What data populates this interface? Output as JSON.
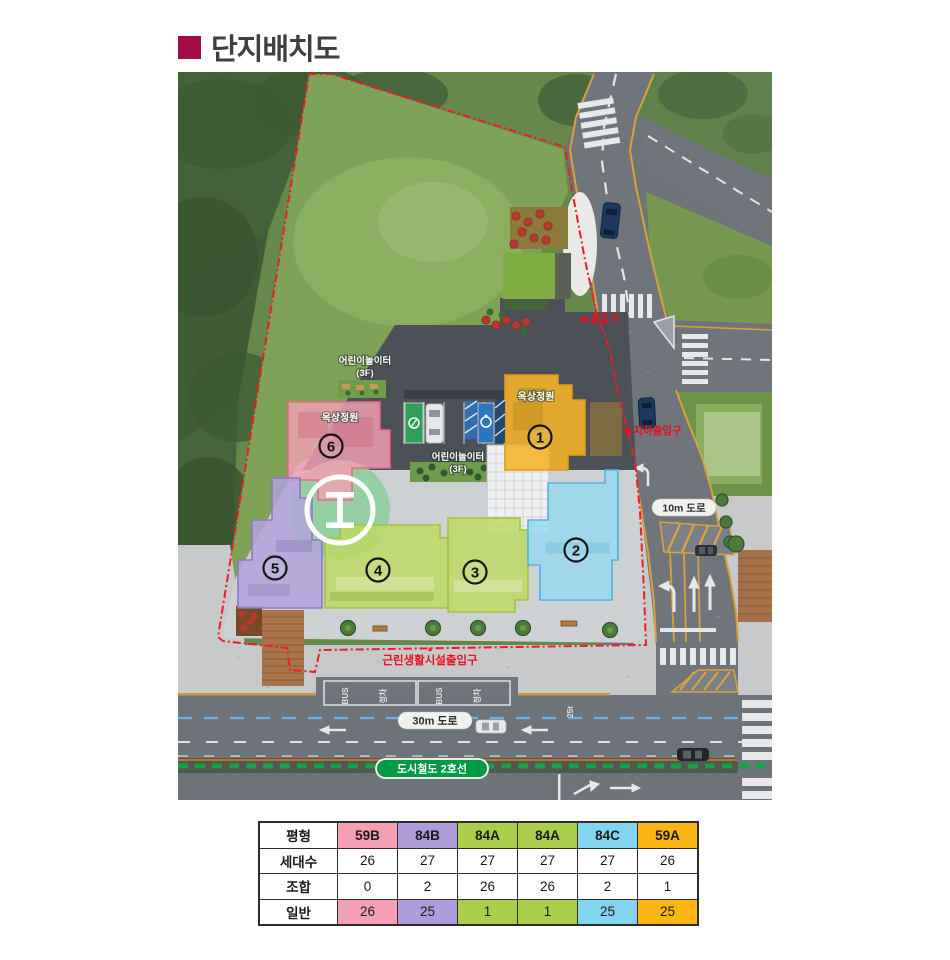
{
  "title": "단지배치도",
  "map": {
    "labels": {
      "playground_top_1": "어린이놀이터",
      "playground_top_2": "(3F)",
      "playground_mid_1": "어린이놀이터",
      "playground_mid_2": "(3F)",
      "roof_garden_b6": "옥상정원",
      "roof_garden_b1": "옥상정원",
      "entrance": "◀ 출입구",
      "underground_entrance": "◀ 지하출입구",
      "shop_entrance_arrow": "▲",
      "shop_entrance": "근린생활시설출입구",
      "road_10m": "10m 도로",
      "road_30m": "30m 도로",
      "subway_line": "도시철도 2호선",
      "bus_marking": "BUS",
      "bus_stop_marking": "정차",
      "weight_limit_marking": "25t"
    },
    "building_numbers": {
      "b1": "1",
      "b2": "2",
      "b3": "3",
      "b4": "4",
      "b5": "5",
      "b6": "6"
    },
    "colors": {
      "boundary": "#ee1c25",
      "subway_green": "#009a44",
      "building_pink": "#f3a0b2",
      "building_purple": "#b2a3dc",
      "building_green": "#bdd964",
      "building_cyan": "#96d8f0",
      "building_orange": "#f5b428"
    }
  },
  "table": {
    "col_header_label": "평형",
    "columns": [
      {
        "type": "59B",
        "color": "#F49FB3"
      },
      {
        "type": "84B",
        "color": "#AE9CD8"
      },
      {
        "type": "84A",
        "color": "#ABCF4C"
      },
      {
        "type": "84A",
        "color": "#ABCF4C"
      },
      {
        "type": "84C",
        "color": "#83D5EF"
      },
      {
        "type": "59A",
        "color": "#FBB514"
      }
    ],
    "rows": [
      {
        "label": "세대수",
        "values": [
          "26",
          "27",
          "27",
          "27",
          "27",
          "26"
        ]
      },
      {
        "label": "조합",
        "values": [
          "0",
          "2",
          "26",
          "26",
          "2",
          "1"
        ]
      },
      {
        "label": "일반",
        "values": [
          "26",
          "25",
          "1",
          "1",
          "25",
          "25"
        ]
      }
    ]
  }
}
